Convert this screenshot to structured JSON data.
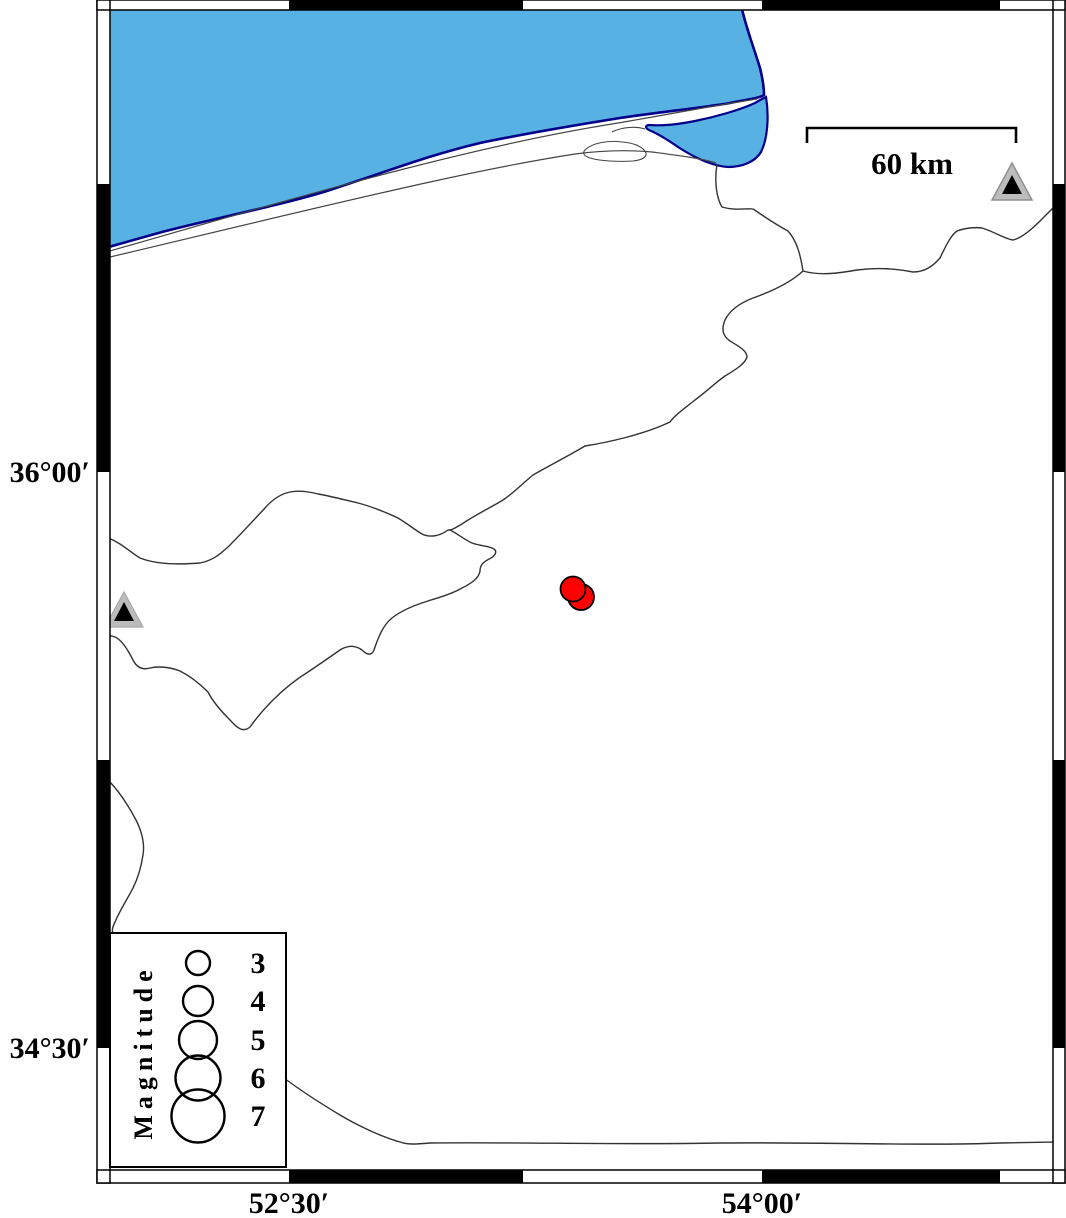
{
  "figure": {
    "type": "seismicity-map",
    "axis": {
      "lat_labels": [
        {
          "label": "36°00′",
          "y": 472
        },
        {
          "label": "34°30′",
          "y": 1048
        }
      ],
      "lon_labels": [
        {
          "label": "52°30′",
          "x": 289
        },
        {
          "label": "54°00′",
          "x": 762
        }
      ]
    },
    "scale_bar": {
      "label": "60 km"
    },
    "legend": {
      "title": "Magnitude",
      "entries": [
        {
          "label": "3",
          "radius": 12
        },
        {
          "label": "4",
          "radius": 15
        },
        {
          "label": "5",
          "radius": 19
        },
        {
          "label": "6",
          "radius": 22.5
        },
        {
          "label": "7",
          "radius": 26.5
        }
      ]
    },
    "map_data": {
      "events": [
        {
          "x": 581,
          "y": 597,
          "radius": 13,
          "approx_magnitude": 3
        },
        {
          "x": 573,
          "y": 589,
          "radius": 12.5,
          "approx_magnitude": 3
        }
      ],
      "stations": [
        {
          "x": 1012,
          "y": 186
        },
        {
          "x": 124,
          "y": 610
        }
      ]
    },
    "colors": {
      "sea_fill": "#57b1e3",
      "coastline": "#00008b",
      "event_fill": "#ff0000",
      "station_fill": "#bcbcbc",
      "boundary_line": "#3a3a3a",
      "frame_black": "#000000"
    }
  }
}
